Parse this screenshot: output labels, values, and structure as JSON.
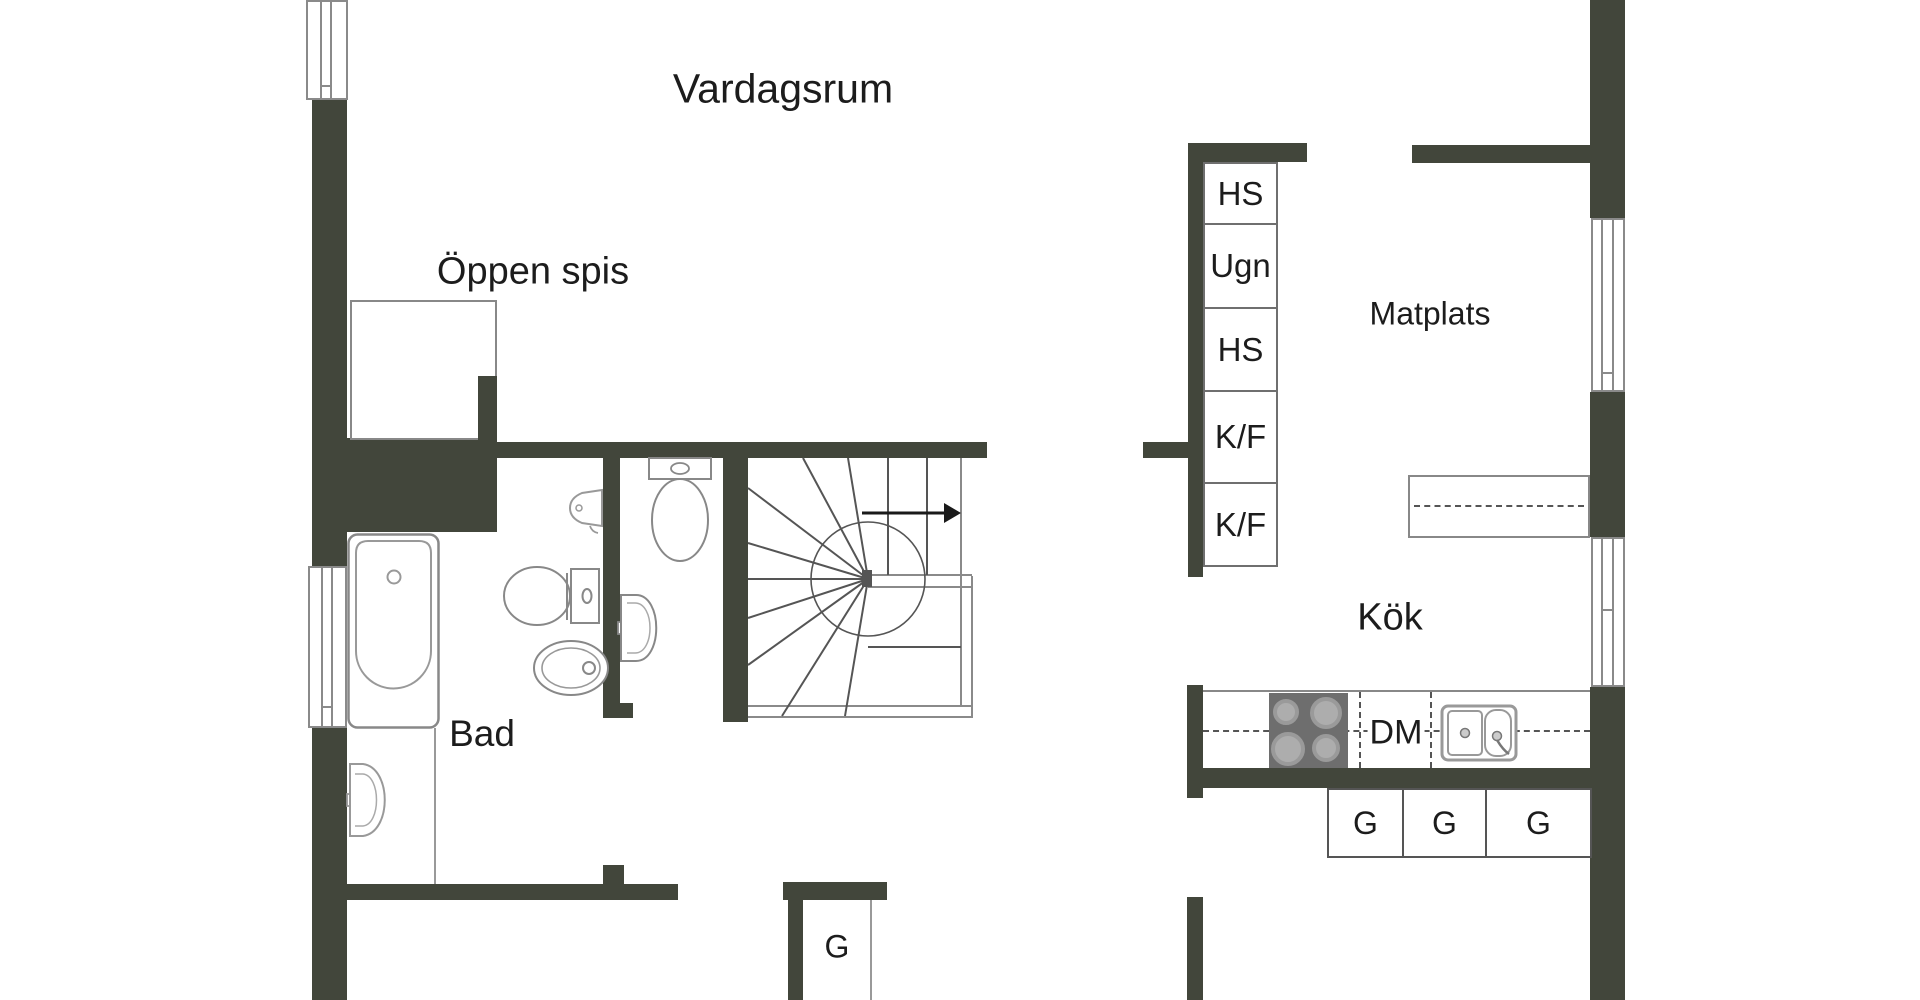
{
  "floor_plan": {
    "rooms": {
      "vardagsrum": {
        "label": "Vardagsrum"
      },
      "oppen_spis": {
        "label": "Öppen spis"
      },
      "matplats": {
        "label": "Matplats"
      },
      "kok": {
        "label": "Kök"
      },
      "bad": {
        "label": "Bad"
      }
    },
    "kitchen": {
      "appliance_column": [
        {
          "label": "HS"
        },
        {
          "label": "Ugn"
        },
        {
          "label": "HS"
        },
        {
          "label": "K/F"
        },
        {
          "label": "K/F"
        }
      ],
      "dishwasher_label": "DM",
      "wardrobes": [
        {
          "label": "G"
        },
        {
          "label": "G"
        },
        {
          "label": "G"
        }
      ]
    },
    "hall": {
      "wardrobe_label": "G"
    },
    "colors": {
      "wall": "#42463b",
      "outline": "#8a8a8a",
      "text": "#1c1c1c",
      "stove": "#6e6e6e"
    }
  }
}
